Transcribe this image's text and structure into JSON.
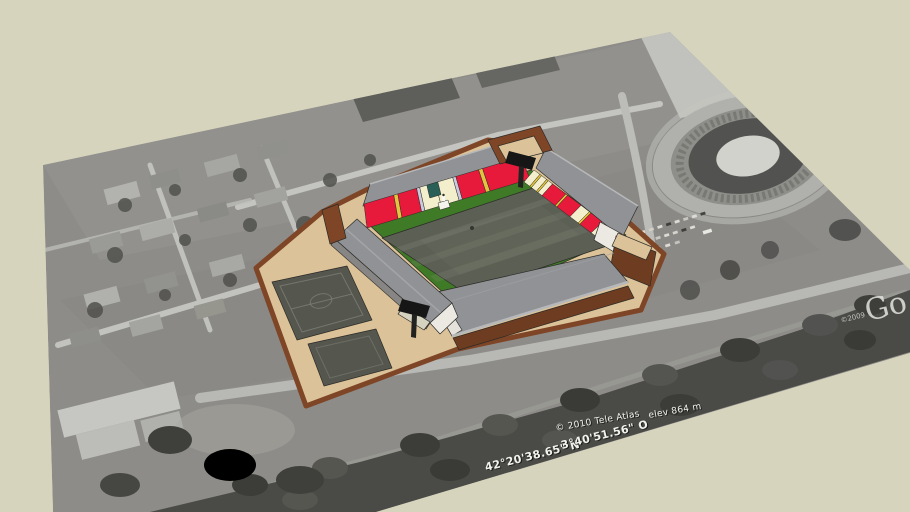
{
  "viewport": {
    "background_color": "#d6d4bc"
  },
  "geo_overlay": {
    "copyright": "© 2010 Tele Atlas",
    "elevation": "elev  864 m",
    "latitude": "42°20'38.65\" N",
    "longitude": "3°40'51.56\" O"
  },
  "watermark": {
    "year": "©2009",
    "partial_logo": "Go"
  },
  "colors": {
    "sky": "#d6d4bc",
    "photo_base": "#8e8c88",
    "platform_tan": "#dcc298",
    "wall_brown": "#7e4526",
    "wall_brown_dark": "#6e3c20",
    "seat_red": "#e81a3c",
    "seat_cream": "#f3eecb",
    "divider_yellow": "#e3c43e",
    "seat_lavender": "#c9cade",
    "press_box_teal": "#2a5f58",
    "surround_green": "#3f7a26",
    "pitch_gray": "#5b5f54",
    "roof_gray": "#909295",
    "roof_light": "#b6b8ba",
    "gable_white": "#ebe9e2",
    "floodlight_black": "#161616",
    "training_pitch": "#55574e",
    "text_white": "#f2f2ee"
  }
}
